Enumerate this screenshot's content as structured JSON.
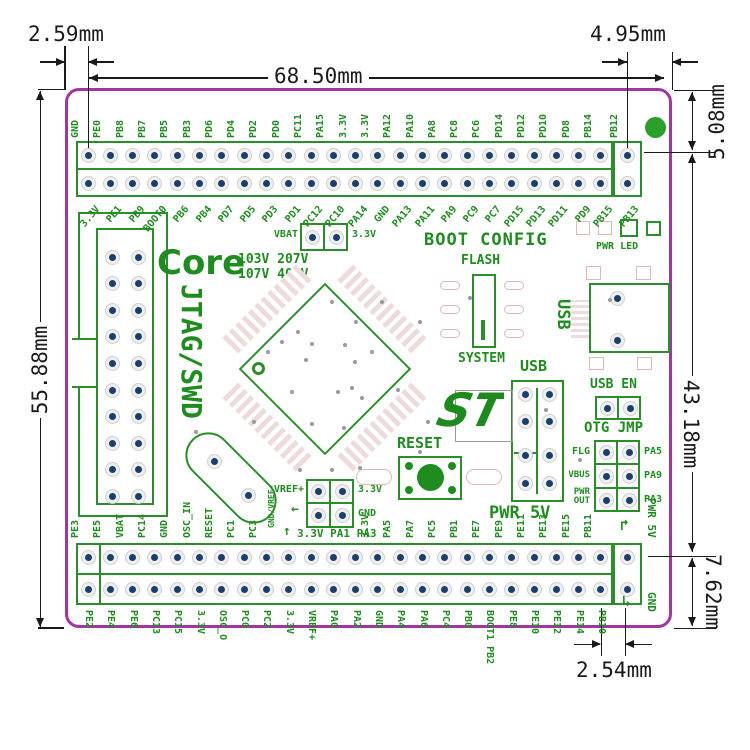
{
  "dimensions": {
    "left_gap": "2.59mm",
    "pin_span": "68.50mm",
    "right_gap": "4.95mm",
    "top_margin": "5.08mm",
    "header_span": "43.18mm",
    "bottom_margin": "7.62mm",
    "board_height": "55.88mm",
    "pin_pitch": "2.54mm"
  },
  "board": {
    "core": {
      "title": "Core",
      "variant_line1": "103V 207V",
      "variant_line2": "107V 407V"
    },
    "jtag_label": "JTAG/SWD",
    "vbat": {
      "left": "VBAT",
      "right": "3.3V"
    },
    "boot": {
      "title": "BOOT CONFIG",
      "flash": "FLASH",
      "system": "SYSTEM"
    },
    "pwr_led": "PWR LED",
    "usb_port": "USB",
    "usb_header": {
      "title": "USB",
      "power": "PWR 5V"
    },
    "usb_en": "USB EN",
    "otg": {
      "title": "OTG JMP",
      "rows": [
        {
          "left": "FLG",
          "right": "PA5"
        },
        {
          "left": "VBUS",
          "right": "PA9"
        },
        {
          "left": "PWR OUT",
          "right": "PA3"
        }
      ]
    },
    "reset": "RESET",
    "vref": {
      "top_left": "VREF+",
      "top_right": "3.3V",
      "bottom_left": "GND/VREF-",
      "bottom_right": "GND",
      "pins": "3.3V PA1 PA3",
      "up_arrow": "↑",
      "left_arrow": "←"
    },
    "pwr5v_out": "PWR 5V",
    "gnd_out": "GND",
    "arrow_tr": "↱",
    "arrow_br": "↳"
  },
  "top_header": {
    "row1": [
      "GND",
      "PE0",
      "PB8",
      "PB7",
      "PB5",
      "PB3",
      "PD6",
      "PD4",
      "PD2",
      "PD0",
      "PC11",
      "PA15",
      "3.3V",
      "3.3V",
      "PA12",
      "PA10",
      "PA8",
      "PC8",
      "PC6",
      "PD14",
      "PD12",
      "PD10",
      "PD8",
      "PB14",
      "PB12"
    ],
    "row2": [
      "3.3V",
      "PE1",
      "PB9",
      "BOOT0",
      "PB6",
      "PB4",
      "PD7",
      "PD5",
      "PD3",
      "PD1",
      "PC12",
      "PC10",
      "PA14",
      "GND",
      "PA13",
      "PA11",
      "PA9",
      "PC9",
      "PC7",
      "PD15",
      "PD13",
      "PD11",
      "PD9",
      "PB15",
      "PB13"
    ]
  },
  "bottom_header": {
    "row1": [
      "PE3",
      "PE5",
      "VBAT",
      "PC14",
      "GND",
      "OSC_IN",
      "RESET",
      "PC1",
      "PC3",
      "",
      "",
      "",
      "",
      "3.3V",
      "PA5",
      "PA7",
      "PC5",
      "PB1",
      "PE7",
      "PE9",
      "PE11",
      "PE13",
      "PE15",
      "PB11",
      ""
    ],
    "row2": [
      "PE2",
      "PE4",
      "PE6",
      "PC13",
      "PC15",
      "3.3V",
      "OSC_O",
      "PC0",
      "PC2",
      "3.3V",
      "VREF+",
      "PA0",
      "PA2",
      "GND",
      "PA4",
      "PA6",
      "PC4",
      "PB0",
      "BOOT1 PB2",
      "PE8",
      "PE10",
      "PE12",
      "PE14",
      "PB10",
      ""
    ]
  }
}
